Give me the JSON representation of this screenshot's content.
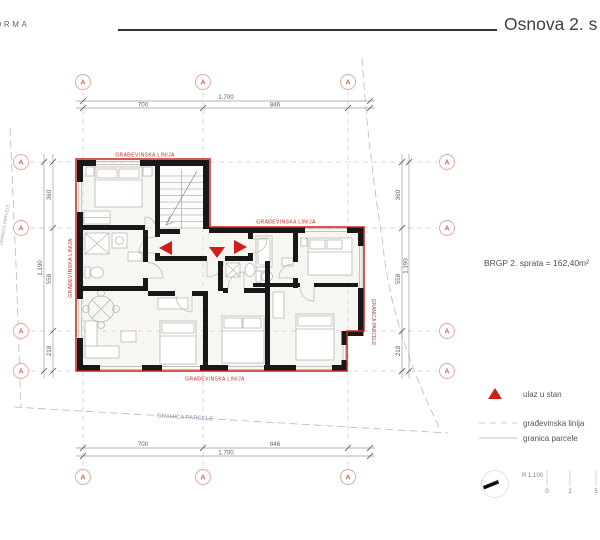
{
  "header": {
    "logo_partial": "ORMA",
    "title": "Osnova 2. s"
  },
  "plan": {
    "grid_label": "A",
    "labels": {
      "building_line": "GRAĐEVINSKA LINIJA",
      "parcel_line": "GRANICA PARCELE"
    },
    "dims": {
      "top_inner": [
        "700",
        "846"
      ],
      "top_outer": "1.700",
      "side": [
        "360",
        "558",
        "218"
      ],
      "side_outer": "1.190"
    },
    "area_note": "BRGP 2. sprata = 162,40m²"
  },
  "legend": {
    "entrance": "ulaz u stan",
    "building_line": "građevinska linija",
    "parcel_line": "granica parcele"
  },
  "scale": {
    "ratio": "R 1:100",
    "ticks": [
      "0",
      "2",
      "5"
    ]
  },
  "colors": {
    "accent_red": "#c9251d",
    "triangle_red": "#d01f17",
    "wall_black": "#181818"
  }
}
